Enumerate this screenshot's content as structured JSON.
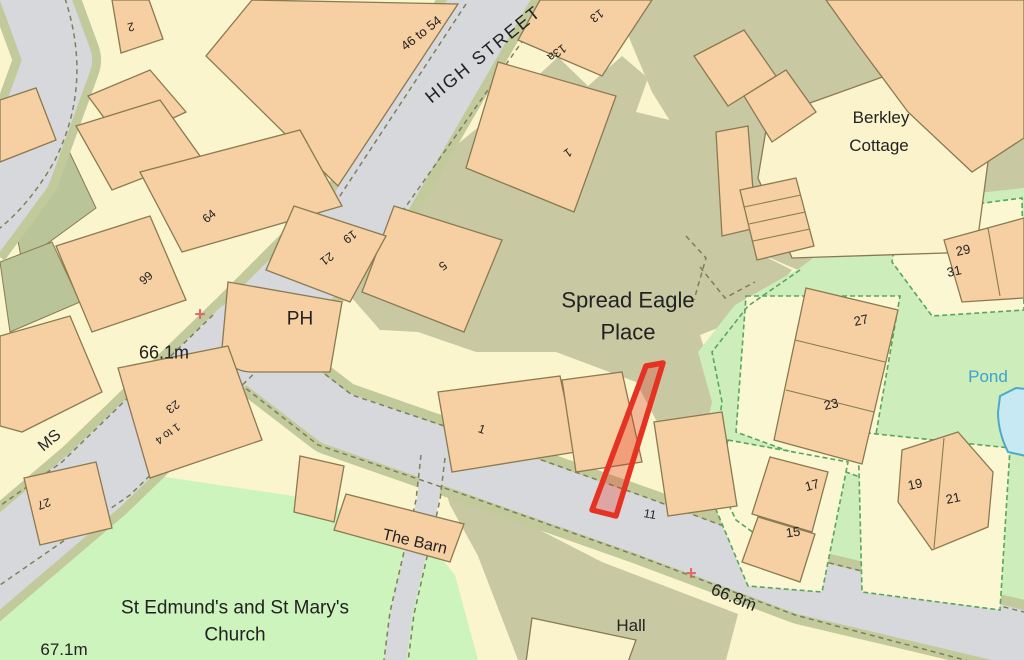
{
  "map": {
    "labels": [
      {
        "text": "2",
        "x": 131,
        "y": 27,
        "rot": 165,
        "size": 12
      },
      {
        "text": "46 to 54",
        "x": 421,
        "y": 33,
        "rot": -38,
        "size": 13
      },
      {
        "text": "HIGH STREET",
        "x": 483,
        "y": 54,
        "rot": -39,
        "size": 18,
        "spacing": 2
      },
      {
        "text": "13",
        "x": 597,
        "y": 16,
        "rot": 144,
        "size": 12
      },
      {
        "text": "13a",
        "x": 557,
        "y": 53,
        "rot": 144,
        "size": 12
      },
      {
        "text": "1",
        "x": 568,
        "y": 153,
        "rot": 144,
        "size": 12
      },
      {
        "text": "Berkley",
        "x": 881,
        "y": 117,
        "rot": 0,
        "size": 17
      },
      {
        "text": "Cottage",
        "x": 879,
        "y": 145,
        "rot": 0,
        "size": 17
      },
      {
        "text": "64",
        "x": 209,
        "y": 216,
        "rot": -40,
        "size": 12
      },
      {
        "text": "66",
        "x": 146,
        "y": 278,
        "rot": 140,
        "size": 12
      },
      {
        "text": "19",
        "x": 350,
        "y": 237,
        "rot": 144,
        "size": 12
      },
      {
        "text": "21",
        "x": 327,
        "y": 259,
        "rot": 144,
        "size": 12
      },
      {
        "text": "5",
        "x": 443,
        "y": 266,
        "rot": 144,
        "size": 12
      },
      {
        "text": "PH",
        "x": 300,
        "y": 318,
        "rot": 0,
        "size": 19
      },
      {
        "text": "66.1m",
        "x": 164,
        "y": 352,
        "rot": 0,
        "size": 18
      },
      {
        "text": "MS",
        "x": 49,
        "y": 440,
        "rot": -40,
        "size": 16
      },
      {
        "text": "23",
        "x": 173,
        "y": 407,
        "rot": 144,
        "size": 12
      },
      {
        "text": "1 to 4",
        "x": 168,
        "y": 434,
        "rot": 144,
        "size": 11
      },
      {
        "text": "27",
        "x": 44,
        "y": 504,
        "rot": 160,
        "size": 12
      },
      {
        "text": "29",
        "x": 963,
        "y": 250,
        "rot": -12,
        "size": 13
      },
      {
        "text": "31",
        "x": 954,
        "y": 271,
        "rot": -12,
        "size": 13
      },
      {
        "text": "Spread Eagle",
        "x": 628,
        "y": 300,
        "rot": 0,
        "size": 22
      },
      {
        "text": "Place",
        "x": 628,
        "y": 332,
        "rot": 0,
        "size": 22
      },
      {
        "text": "Pond",
        "x": 988,
        "y": 376,
        "rot": 0,
        "size": 17,
        "cls": "pond-text"
      },
      {
        "text": "27",
        "x": 861,
        "y": 320,
        "rot": -12,
        "size": 13
      },
      {
        "text": "23",
        "x": 831,
        "y": 404,
        "rot": -12,
        "size": 13
      },
      {
        "text": "1",
        "x": 482,
        "y": 429,
        "rot": 20,
        "size": 12
      },
      {
        "text": "11",
        "x": 650,
        "y": 514,
        "rot": 10,
        "size": 12
      },
      {
        "text": "17",
        "x": 812,
        "y": 485,
        "rot": -15,
        "size": 13
      },
      {
        "text": "15",
        "x": 793,
        "y": 532,
        "rot": -8,
        "size": 13
      },
      {
        "text": "19",
        "x": 915,
        "y": 484,
        "rot": -12,
        "size": 13
      },
      {
        "text": "21",
        "x": 953,
        "y": 498,
        "rot": -12,
        "size": 13
      },
      {
        "text": "The Barn",
        "x": 415,
        "y": 541,
        "rot": 13,
        "size": 16
      },
      {
        "text": "St Edmund's and St Mary's",
        "x": 235,
        "y": 607,
        "rot": 0,
        "size": 19
      },
      {
        "text": "Church",
        "x": 235,
        "y": 634,
        "rot": 0,
        "size": 19
      },
      {
        "text": "67.1m",
        "x": 64,
        "y": 649,
        "rot": 0,
        "size": 17
      },
      {
        "text": "Hall",
        "x": 631,
        "y": 625,
        "rot": 0,
        "size": 17
      },
      {
        "text": "66.8m",
        "x": 734,
        "y": 597,
        "rot": 22,
        "size": 17
      }
    ],
    "benchmarks": [
      {
        "symbol": "+",
        "x": 200,
        "y": 314
      },
      {
        "symbol": "+",
        "x": 691,
        "y": 573
      }
    ],
    "highlight": {
      "outline_color": "#e53222",
      "fill_color": "#e53222",
      "fill_opacity": 0.3
    },
    "colors": {
      "road": "#d7d8dc",
      "road_verge": "#c2c99b",
      "building": "#f6cfa2",
      "parcel_cream": "#faf5cd",
      "courtyard_khaki": "#c8c9a3",
      "residential_green": "#cdeeba",
      "church_green": "#ccf4bc",
      "plot_dash_green": "#58a55c",
      "pond_fill": "#c6e9f4",
      "pond_outline": "#4fa9c5",
      "pond_text": "#3fa0d0",
      "benchmark_cross": "#dd6b66",
      "building_outline": "#8a7a50"
    }
  }
}
